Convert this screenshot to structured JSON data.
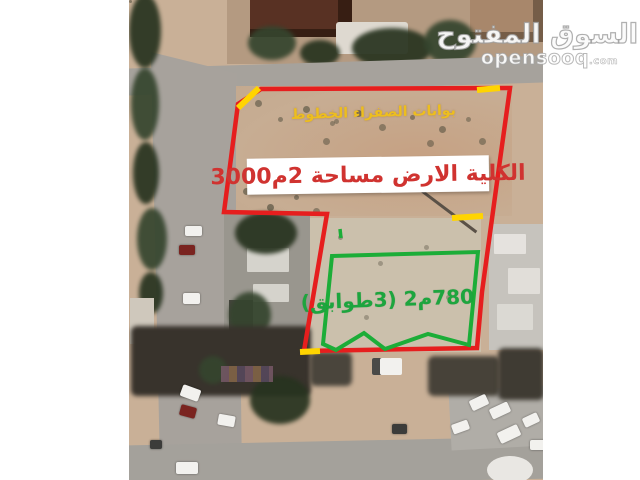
{
  "colors": {
    "boundary_red": "#e61e1e",
    "boundary_green": "#1cad38",
    "gate_yellow": "#ffd400",
    "yellow_text": "#edbe1e",
    "red_text": "#d03330",
    "green_text": "#1da53e",
    "label_box_bg": "#ffffff"
  },
  "watermark": {
    "logo": "السوق المفتوح",
    "site": "opensooq",
    "tld": ".com"
  },
  "annotations": {
    "gates_note": {
      "tokens_visual": [
        "الخطوط",
        " ",
        "الصفراء",
        " ",
        "بوابات"
      ]
    },
    "total_area": {
      "tokens_visual": [
        "3000",
        "م",
        "2",
        " ",
        "مساحة",
        " ",
        "الارض",
        " ",
        "الكلية"
      ]
    },
    "building": {
      "text": "780م2 (3طوابق)"
    }
  }
}
